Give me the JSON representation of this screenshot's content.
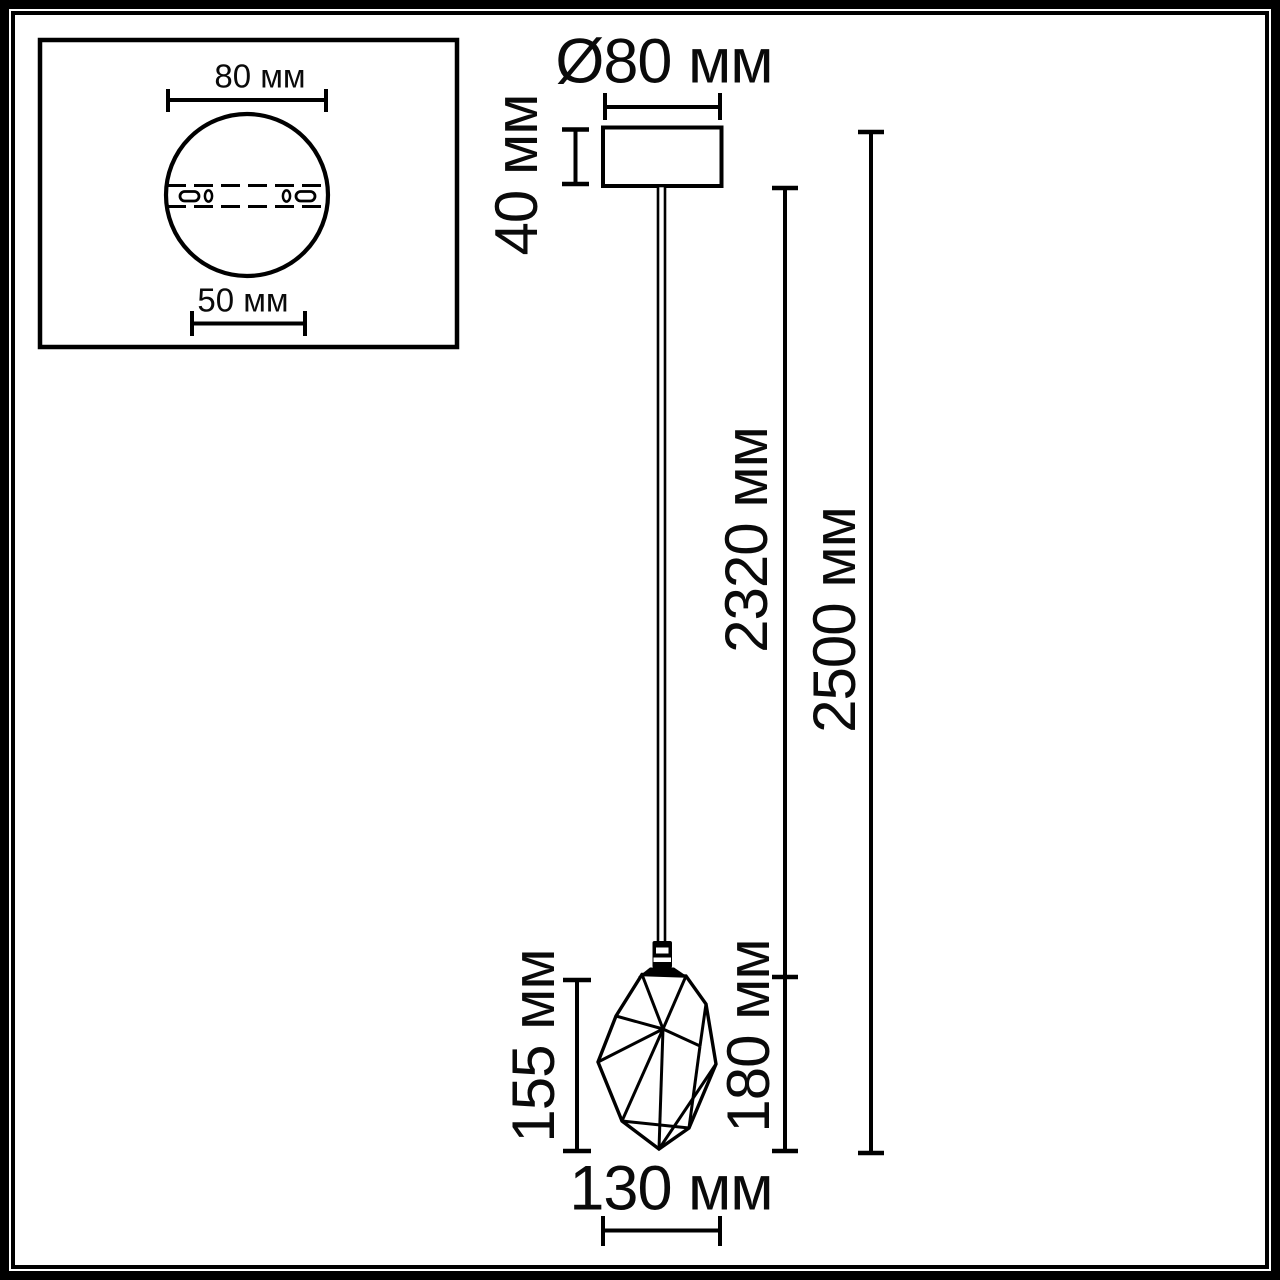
{
  "drawing": {
    "inset": {
      "plate_width_top": "80 мм",
      "plate_width_bottom": "50 мм"
    },
    "dimensions": {
      "canopy_diameter": "Ø80 мм",
      "canopy_height": "40 мм",
      "cord_length": "2320 мм",
      "overall_height": "2500 мм",
      "shade_height": "155 мм",
      "shade_drop": "180 мм",
      "shade_width": "130 мм"
    },
    "colors": {
      "line": "#000000",
      "background": "#ffffff"
    }
  }
}
